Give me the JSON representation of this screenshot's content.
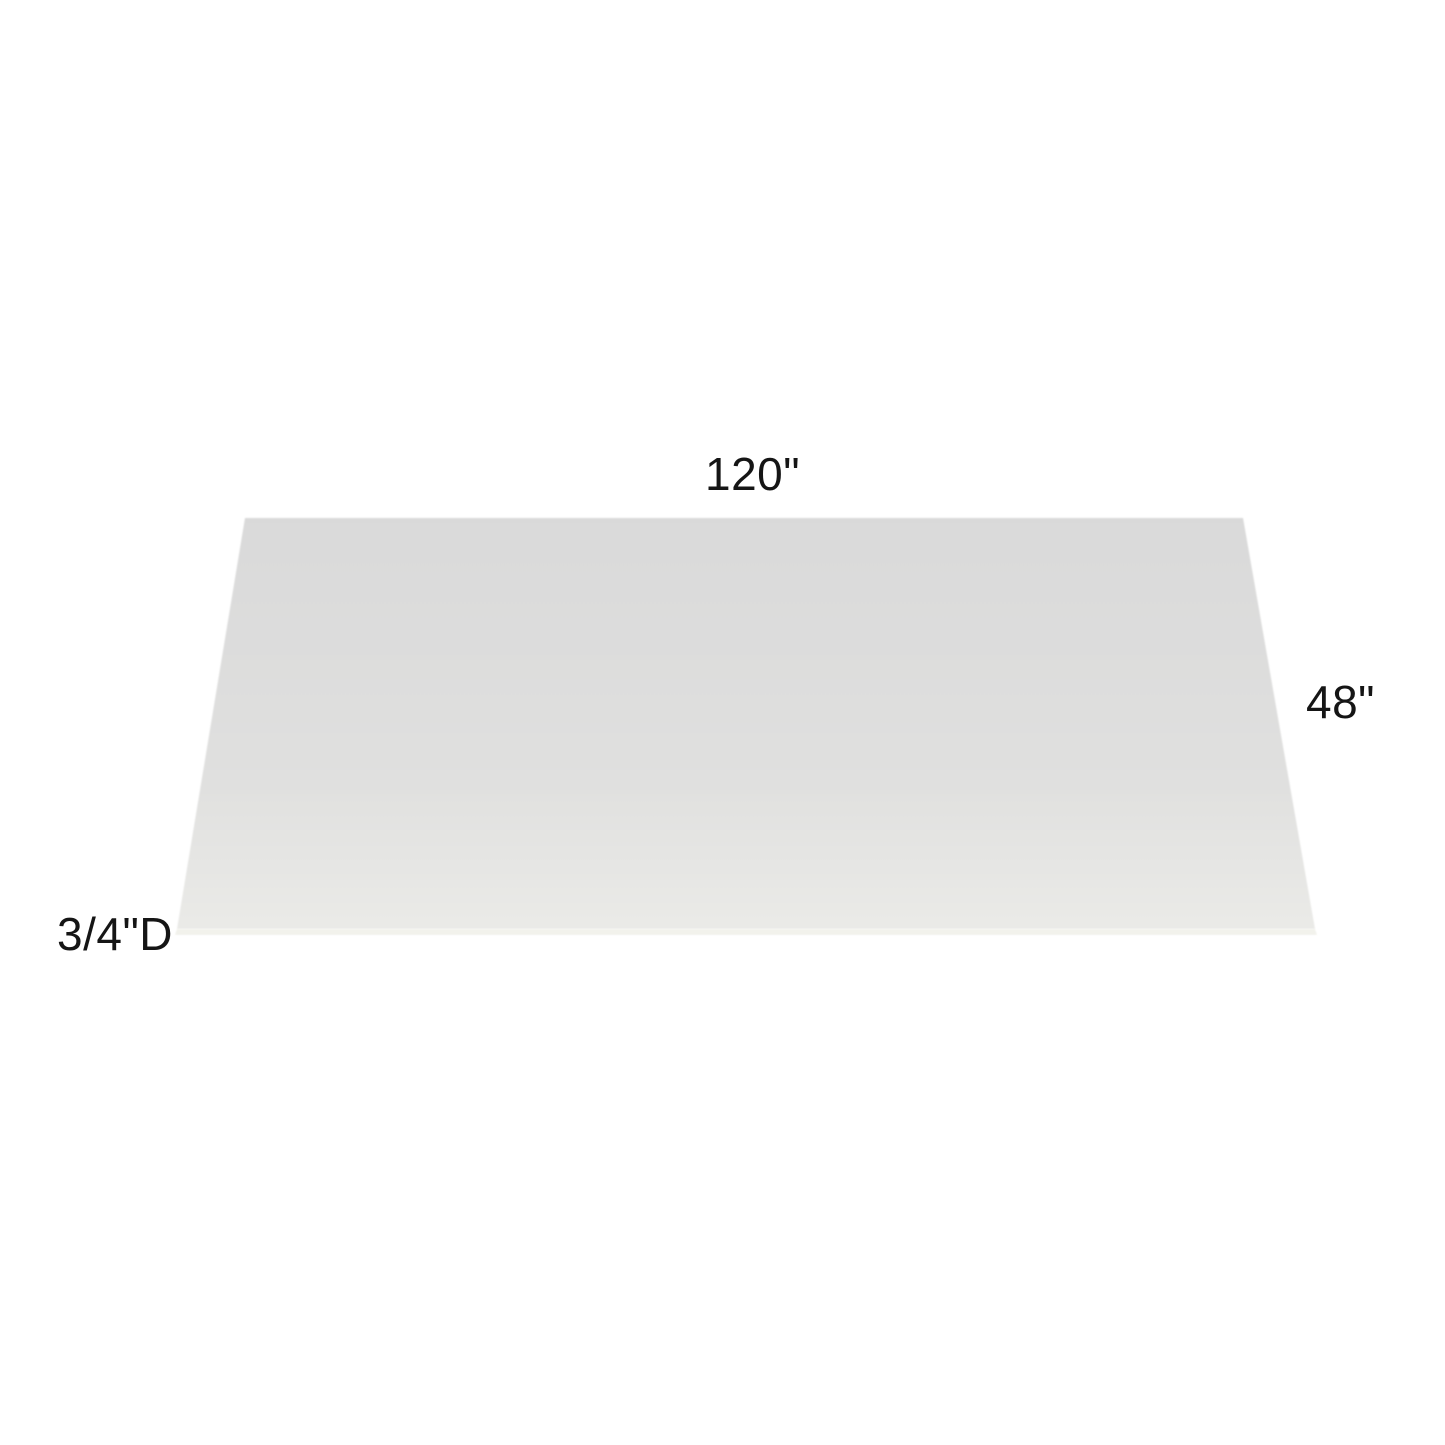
{
  "diagram": {
    "subject": "flat-rectangular-panel-perspective-view",
    "background_color": "#ffffff",
    "labels": {
      "width": "120\"",
      "height": "48\"",
      "depth": "3/4\"D"
    },
    "label_color": "#151515",
    "panel": {
      "surface_color_top": "#d9d9d9",
      "surface_color_mid": "#e0e0df",
      "surface_color_bottom": "#eaeae7",
      "front_edge_color": "#f2f2ec",
      "bottom_line_color": "#8a8a83"
    }
  }
}
